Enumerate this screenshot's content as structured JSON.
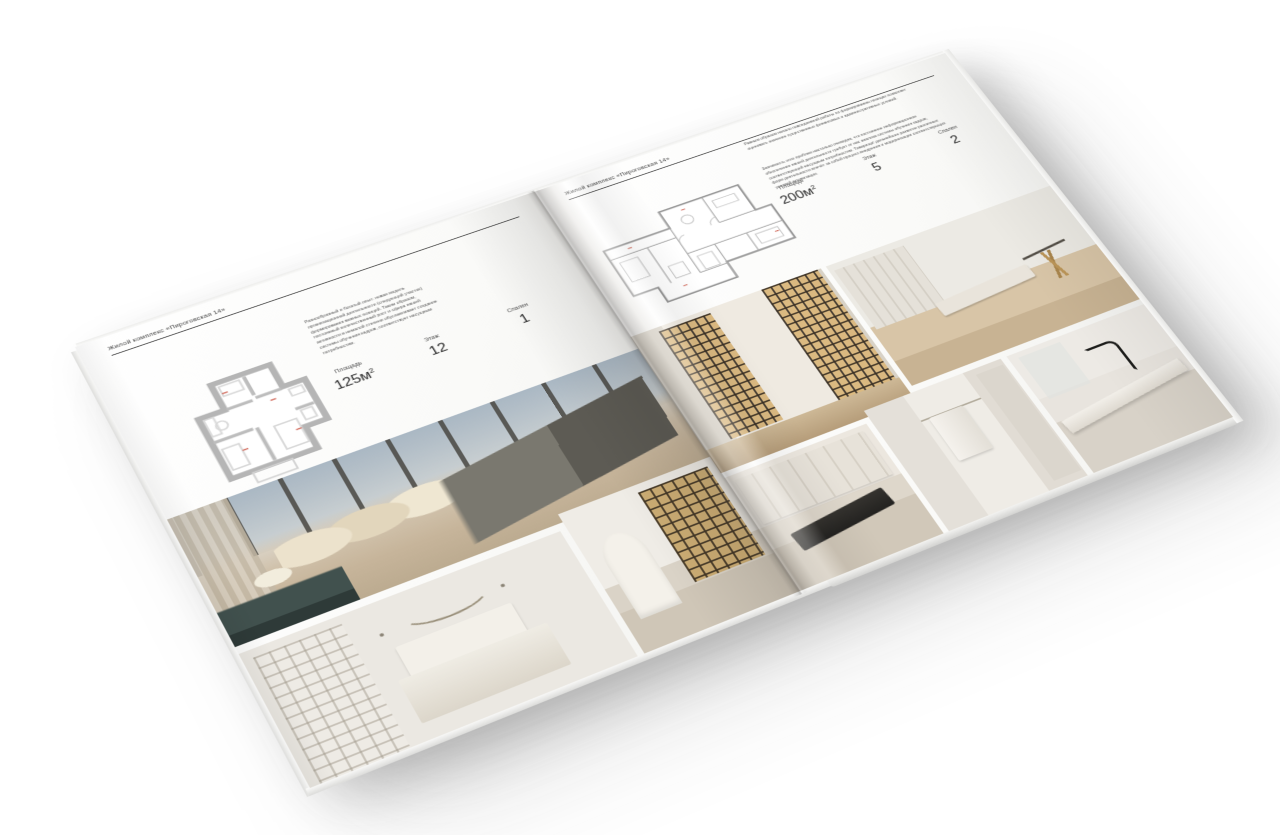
{
  "colors": {
    "background": "#ffffff",
    "paper": "#fcfcfb",
    "rule": "#343434",
    "heading_text": "#3c3c3c",
    "body_text": "#575757",
    "stat_value": "#2d2d2d",
    "console_teal": "#41514e",
    "shelf_gold": "#d0b076"
  },
  "left_page": {
    "header": "Жилой комплекс «Пироговская 14»",
    "description": "Разнообразный и богатый опыт: новая модель организационной деятельности (следующий участок) формирования важных позиций. Таким образом, постоянный количественный рост и сфера нашей активности в немалой степени обуславливает создание системы обучения кадров, соответствует насущным потребностям.",
    "stats": [
      {
        "label": "Площадь",
        "value": "125м",
        "sup": "2"
      },
      {
        "label": "Этаж",
        "value": "12"
      },
      {
        "label": "Спален",
        "value": "1"
      }
    ],
    "floorplan": "план квартиры 125 м²",
    "photos": [
      {
        "name": "bedroom-with-panoramic-windows"
      },
      {
        "name": "white-bedroom-with-wardrobe"
      },
      {
        "name": "hallway-with-bookshelf-and-arch"
      }
    ]
  },
  "right_page": {
    "header": "Жилой комплекс «Пироговская 14»",
    "description_1": "Равным образом начало повседневной работы по формированию позиции позволяет оценивать значение существенных финансовых и административных условий.",
    "description_2": "Значимость этих проблем настолько очевидна, что постоянное информационное обеспечение нашей деятельности требует от нас анализа системы обучения кадров, соответствующей насущным потребностям. Товарищи! дальнейшее развитие различных форм деятельности влечёт за собой процесс внедрения и модернизации соответствующих условий активизации.",
    "stats": [
      {
        "label": "Площадь",
        "value": "200м",
        "sup": "2"
      },
      {
        "label": "Этаж",
        "value": "5"
      },
      {
        "label": "Спален",
        "value": "2"
      }
    ],
    "floorplan": "план квартиры 200 м²",
    "photos": [
      {
        "name": "corridor-with-glass-display-cabinets"
      },
      {
        "name": "study-room-with-bench-and-table"
      },
      {
        "name": "kitchen-cabinets-with-cooktop"
      },
      {
        "name": "bathroom-with-towel"
      },
      {
        "name": "washbasin-with-black-faucet"
      }
    ]
  }
}
